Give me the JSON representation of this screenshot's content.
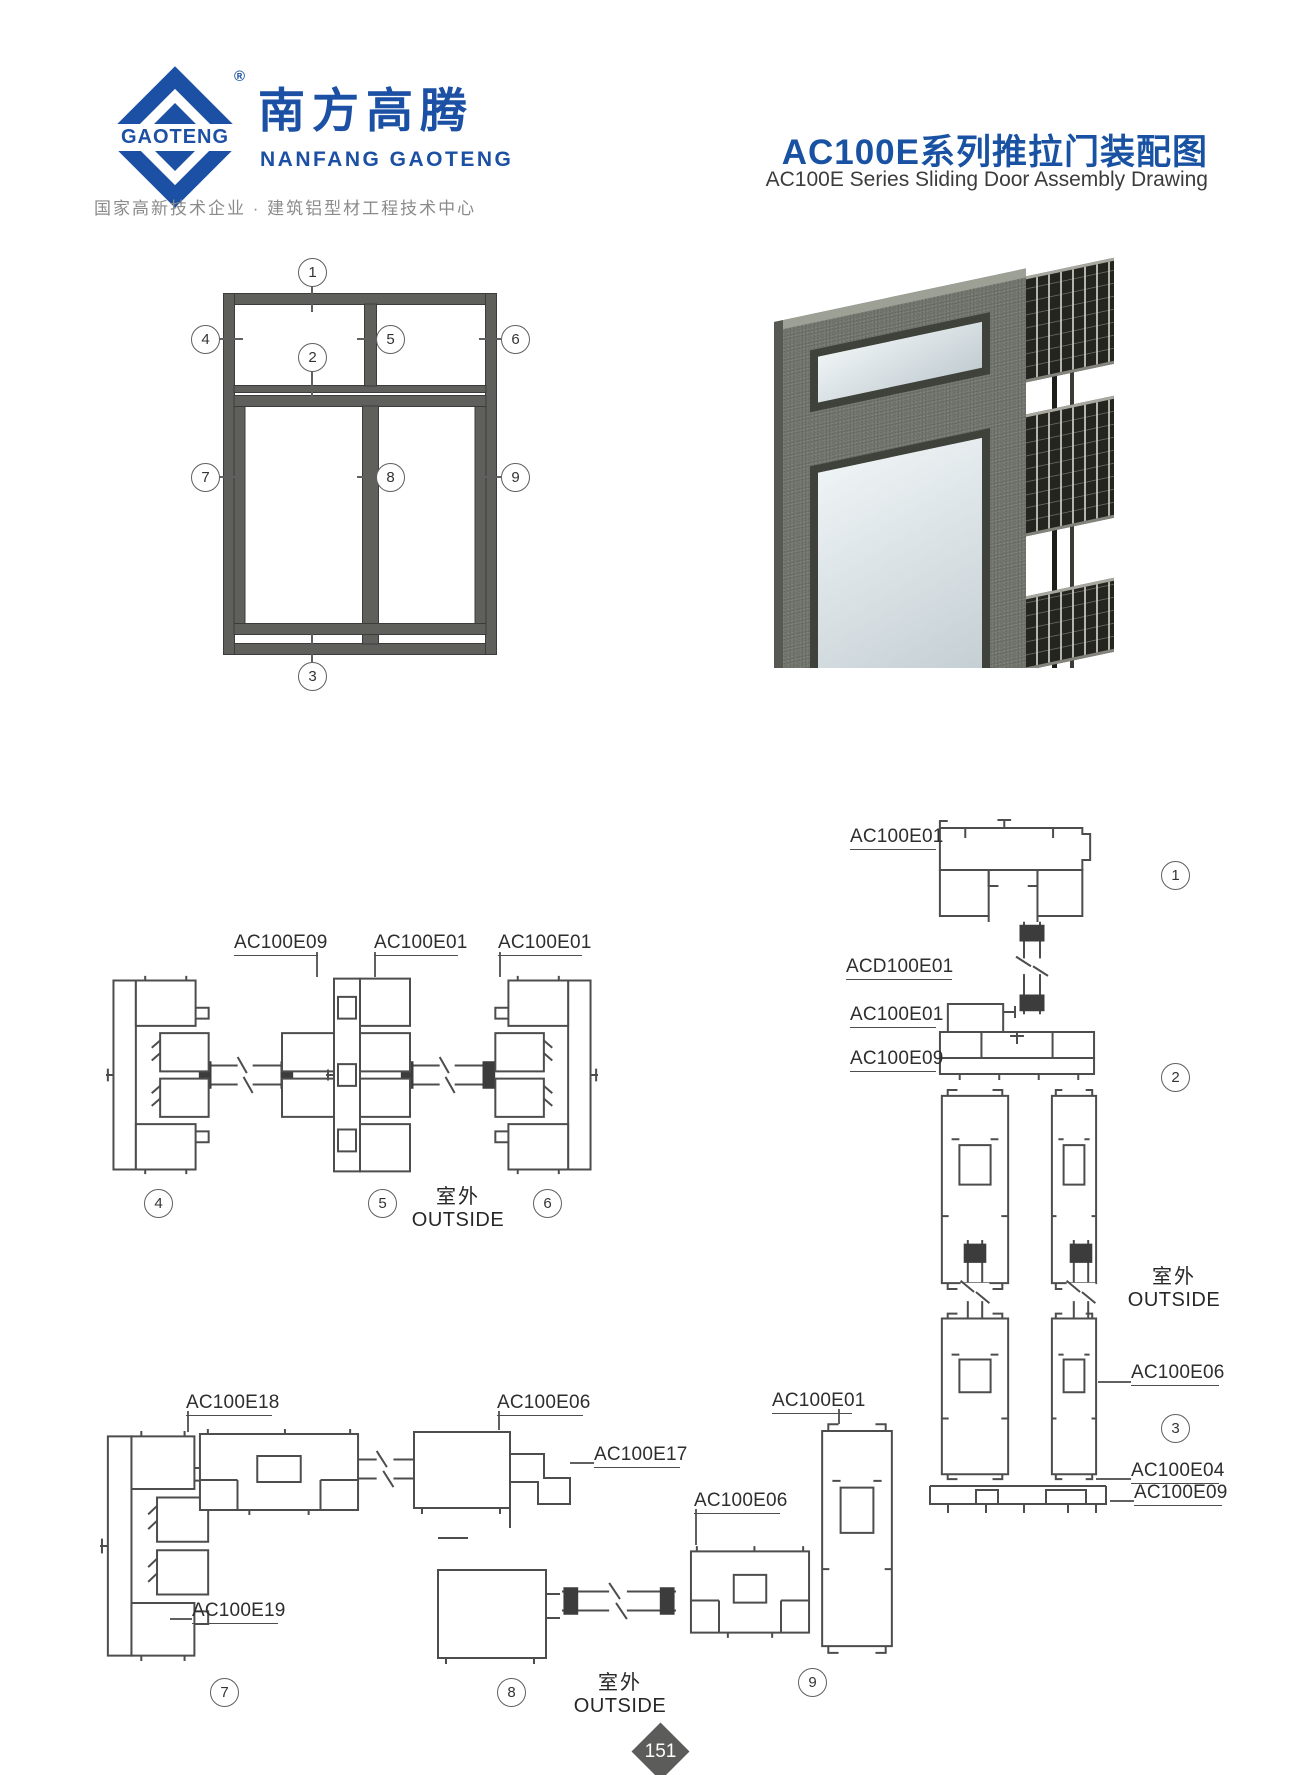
{
  "brand": {
    "logo_text": "GAOTENG",
    "registered": "®",
    "company_cn": "南方高腾",
    "company_en": "NANFANG GAOTENG",
    "tagline": "国家高新技术企业 · 建筑铝型材工程技术中心",
    "accent_color": "#1b50a4"
  },
  "header": {
    "title_cn": "AC100E系列推拉门装配图",
    "title_en": "AC100E Series Sliding Door Assembly Drawing"
  },
  "elevation": {
    "callouts": [
      "1",
      "2",
      "3",
      "4",
      "5",
      "6",
      "7",
      "8",
      "9"
    ]
  },
  "outside": {
    "cn": "室外",
    "en": "OUTSIDE"
  },
  "sections_top": {
    "labels": [
      "AC100E09",
      "AC100E01",
      "AC100E01"
    ],
    "callouts": [
      "4",
      "5",
      "6"
    ]
  },
  "sections_right": {
    "labels": [
      "AC100E01",
      "ACD100E01",
      "AC100E01",
      "AC100E09",
      "AC100E06",
      "AC100E04",
      "AC100E09"
    ],
    "callouts": [
      "1",
      "2",
      "3"
    ]
  },
  "sections_bottom": {
    "labels": [
      "AC100E18",
      "AC100E06",
      "AC100E17",
      "AC100E06",
      "AC100E01",
      "AC100E19"
    ],
    "callouts": [
      "7",
      "8",
      "9"
    ]
  },
  "footer": {
    "page_number": "151"
  }
}
